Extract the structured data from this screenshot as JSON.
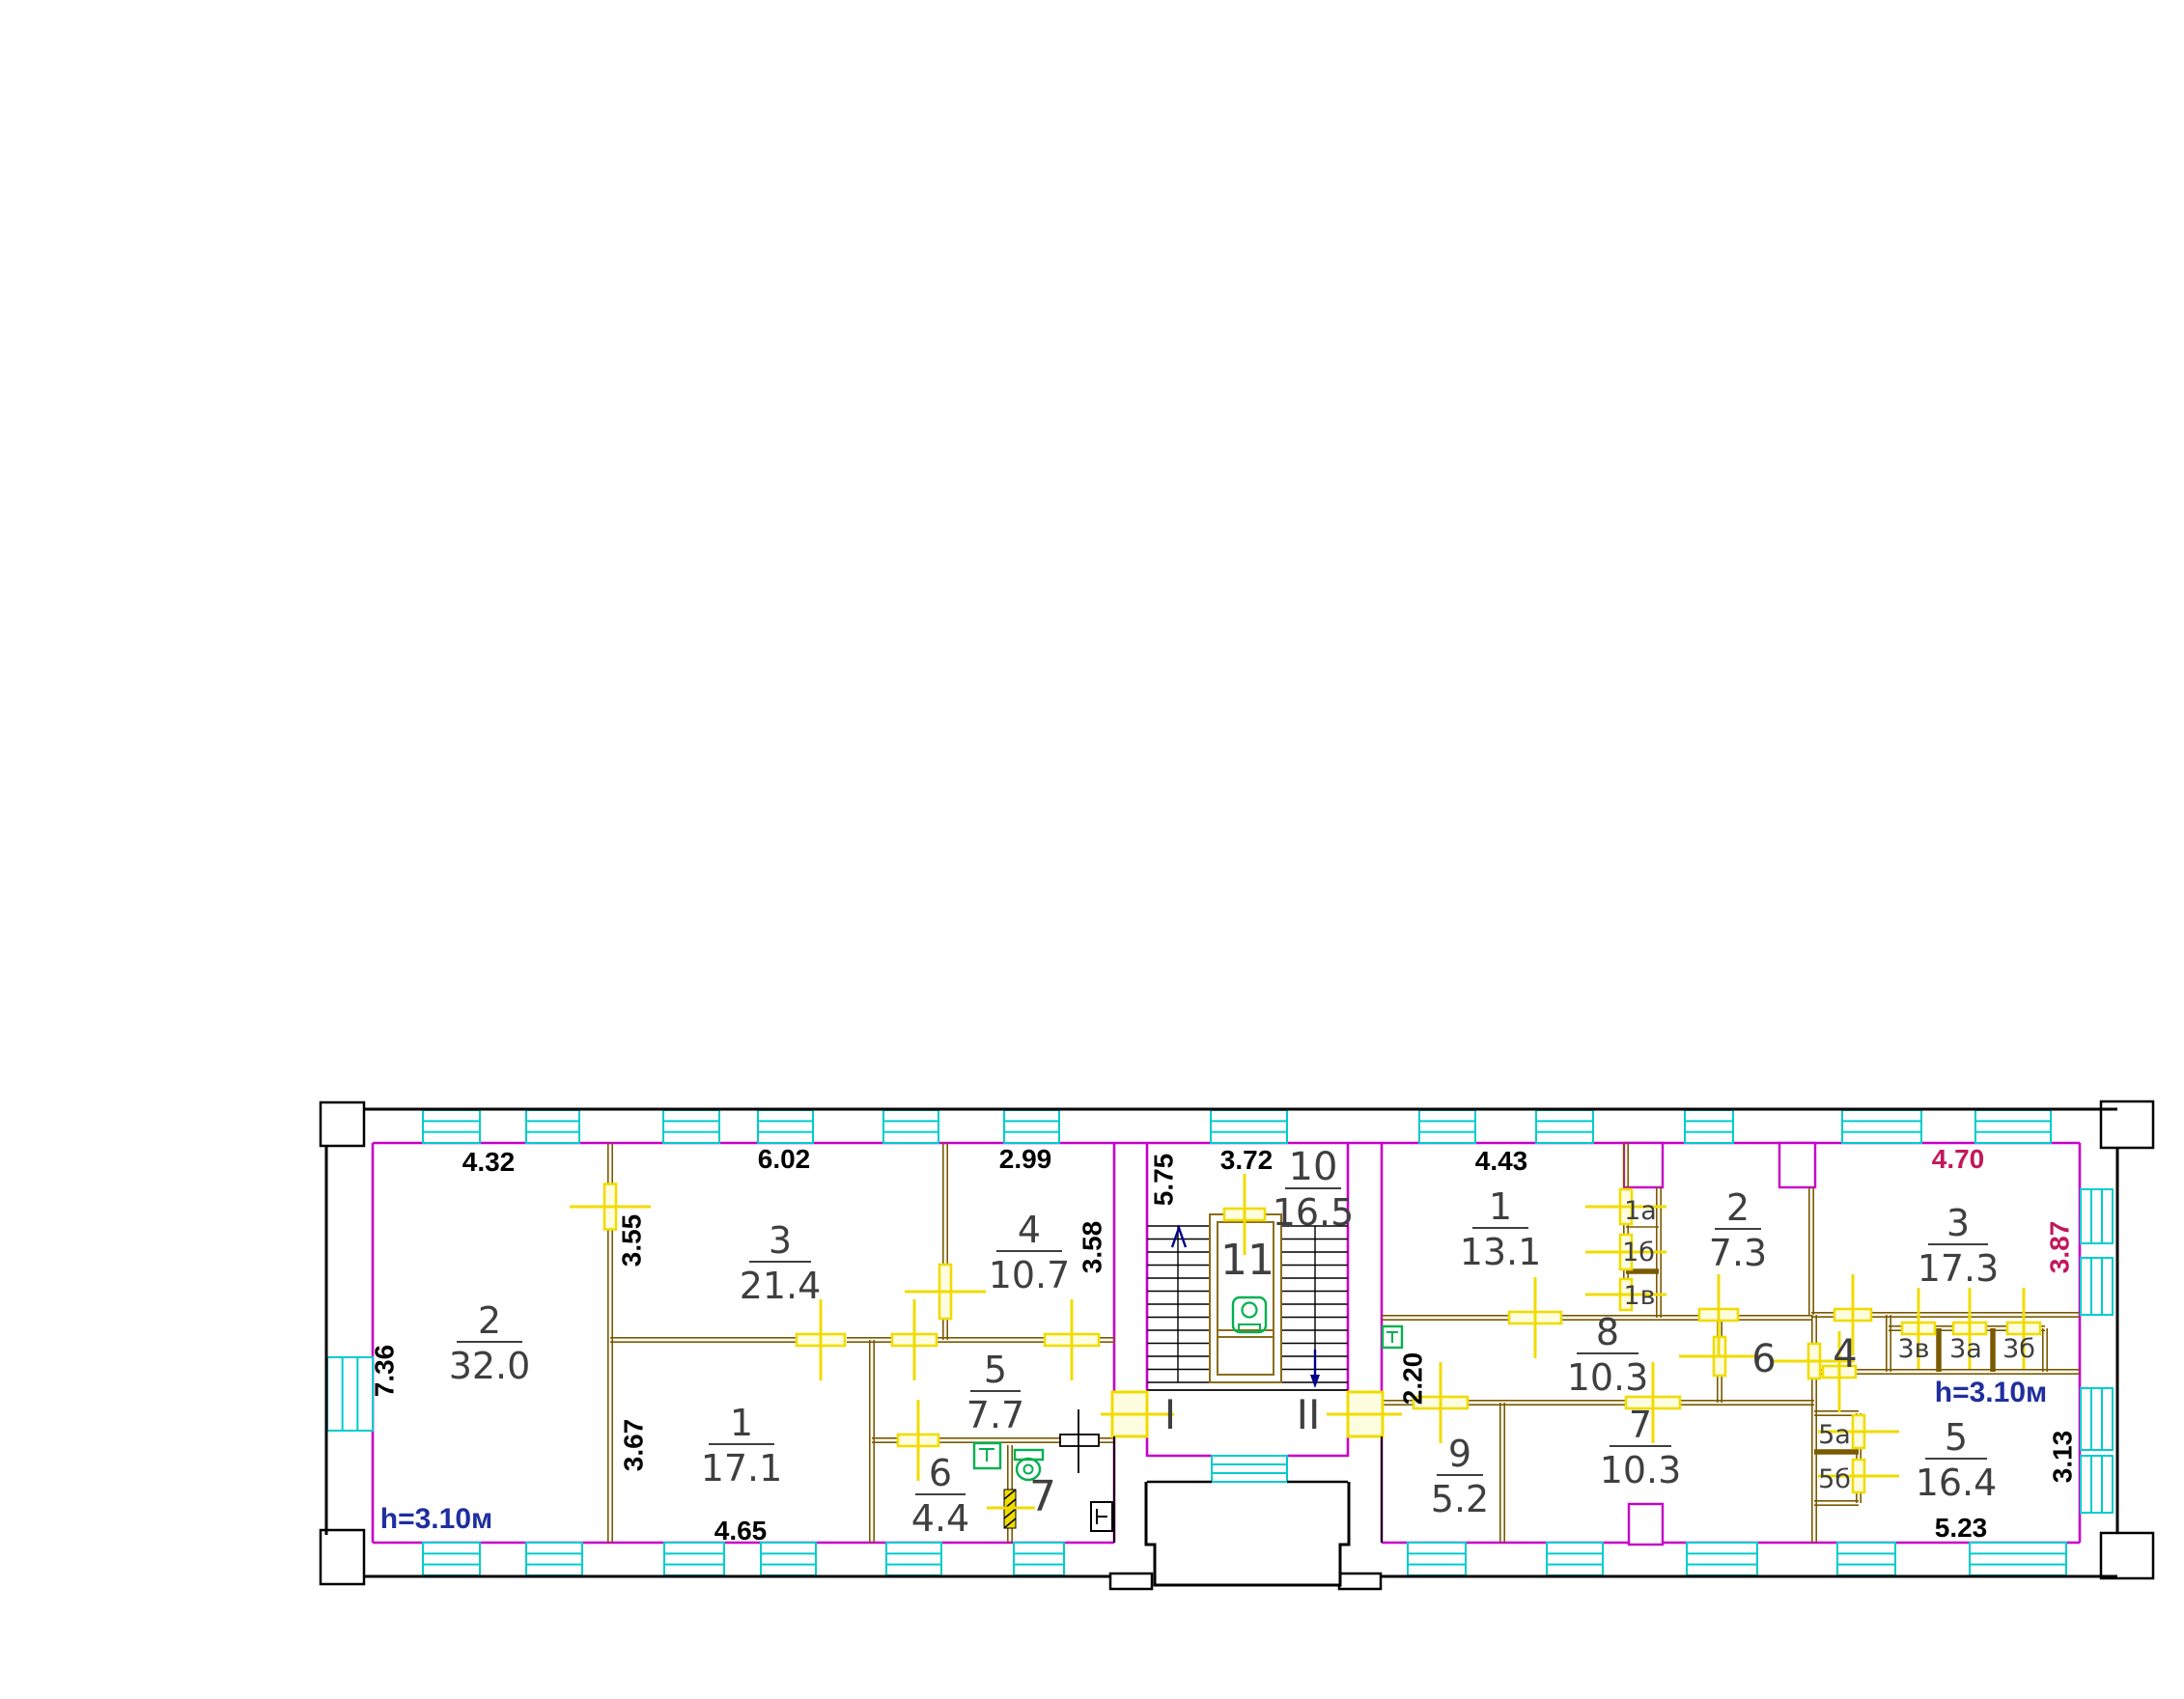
{
  "header": {
    "line1": "2138263\\2 этаж",
    "line2": "Адрес: Октябрьская ул., д.80, стр.3",
    "line3": "Дата: 1931 г."
  },
  "rooms": {
    "l2": {
      "num": "2",
      "area": "32.0"
    },
    "l3": {
      "num": "3",
      "area": "21.4"
    },
    "l4": {
      "num": "4",
      "area": "10.7"
    },
    "l1": {
      "num": "1",
      "area": "17.1"
    },
    "l5": {
      "num": "5",
      "area": "7.7"
    },
    "l6": {
      "num": "6",
      "area": "4.4"
    },
    "l7": {
      "num": "7"
    },
    "stair": {
      "num": "11"
    },
    "r10": {
      "num": "10",
      "area": "16.5"
    },
    "r1": {
      "num": "1",
      "area": "13.1"
    },
    "r1a": {
      "num": "1а"
    },
    "r1b": {
      "num": "1б"
    },
    "r1v": {
      "num": "1в"
    },
    "r2": {
      "num": "2",
      "area": "7.3"
    },
    "r8": {
      "num": "8",
      "area": "10.3"
    },
    "r6": {
      "num": "6"
    },
    "r9": {
      "num": "9",
      "area": "5.2"
    },
    "r7": {
      "num": "7",
      "area": "10.3"
    },
    "r5a": {
      "num": "5а"
    },
    "r5b": {
      "num": "5б"
    },
    "r4": {
      "num": "4"
    },
    "r3v": {
      "num": "3в"
    },
    "r3a": {
      "num": "3а"
    },
    "r3b": {
      "num": "3б"
    },
    "r3": {
      "num": "3",
      "area": "17.3"
    },
    "r5": {
      "num": "5",
      "area": "16.4"
    }
  },
  "dims": {
    "d432": "4.32",
    "d602": "6.02",
    "d299": "2.99",
    "d372": "3.72",
    "d443": "4.43",
    "d470": "4.70",
    "d736": "7.36",
    "d355": "3.55",
    "d358": "3.58",
    "d575": "5.75",
    "d367": "3.67",
    "d465": "4.65",
    "d220": "2.20",
    "d387": "3.87",
    "d313": "3.13",
    "d523": "5.23"
  },
  "notes": {
    "height_left": "h=3.10м",
    "height_right": "h=3.10м"
  },
  "entrances": {
    "one": "I",
    "two": "II"
  },
  "colors": {
    "exterior_wall": "#000000",
    "inner_wall": "#c800c8",
    "partition": "#7a5a00",
    "window": "#00cccc",
    "door": "#f0dc00",
    "fixture": "#00b050",
    "dimension_text": "#000000",
    "accent_dimension": "#c2185b",
    "height_note": "#1f2f9f",
    "room_label": "#3f3f3f"
  }
}
